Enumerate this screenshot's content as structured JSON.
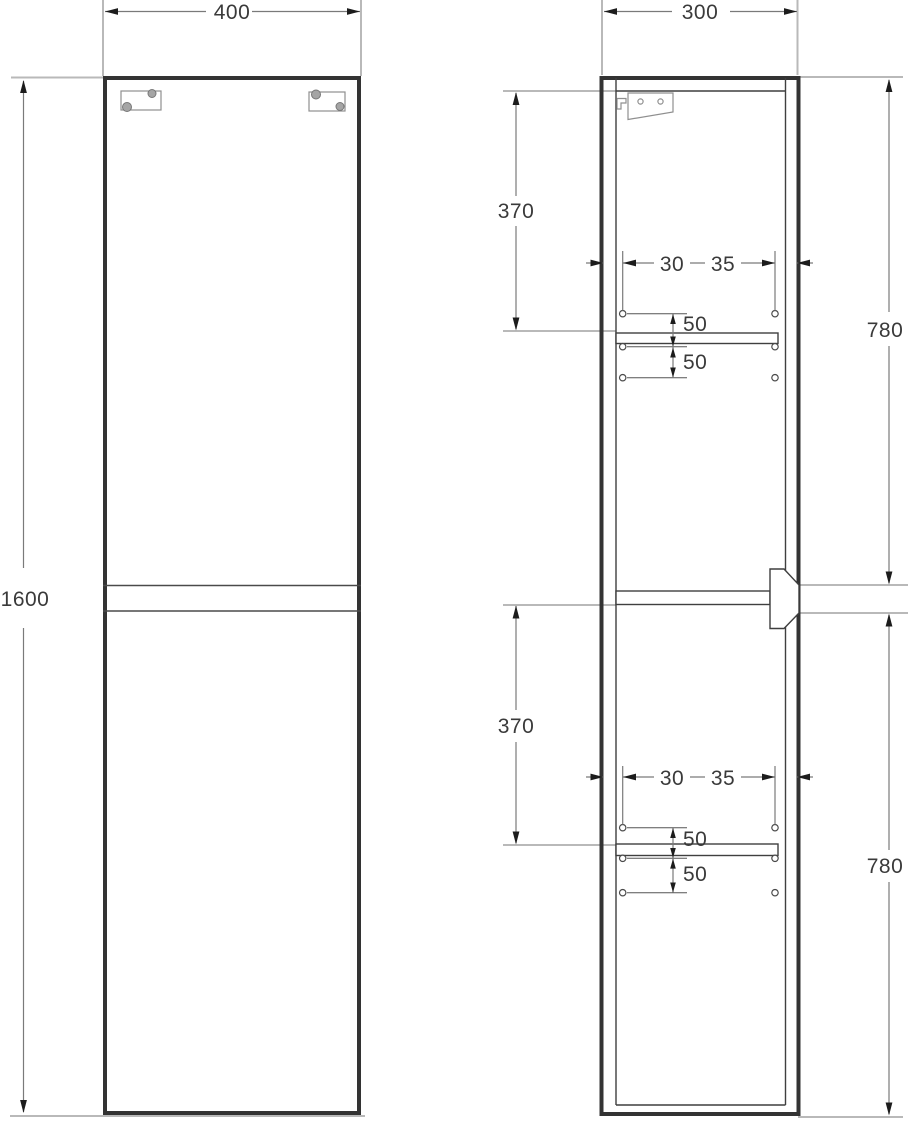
{
  "drawing": {
    "front_view": {
      "width": "400",
      "height": "1600"
    },
    "side_view": {
      "depth": "300",
      "upper_section": {
        "shelf_offset": "370",
        "door_height": "780",
        "hole_inset_left": "30",
        "hole_inset_right": "35",
        "hole_spacing": [
          "50",
          "50"
        ]
      },
      "lower_section": {
        "shelf_offset": "370",
        "door_height": "780",
        "hole_inset_left": "30",
        "hole_inset_right": "35",
        "hole_spacing": [
          "50",
          "50"
        ]
      }
    }
  }
}
